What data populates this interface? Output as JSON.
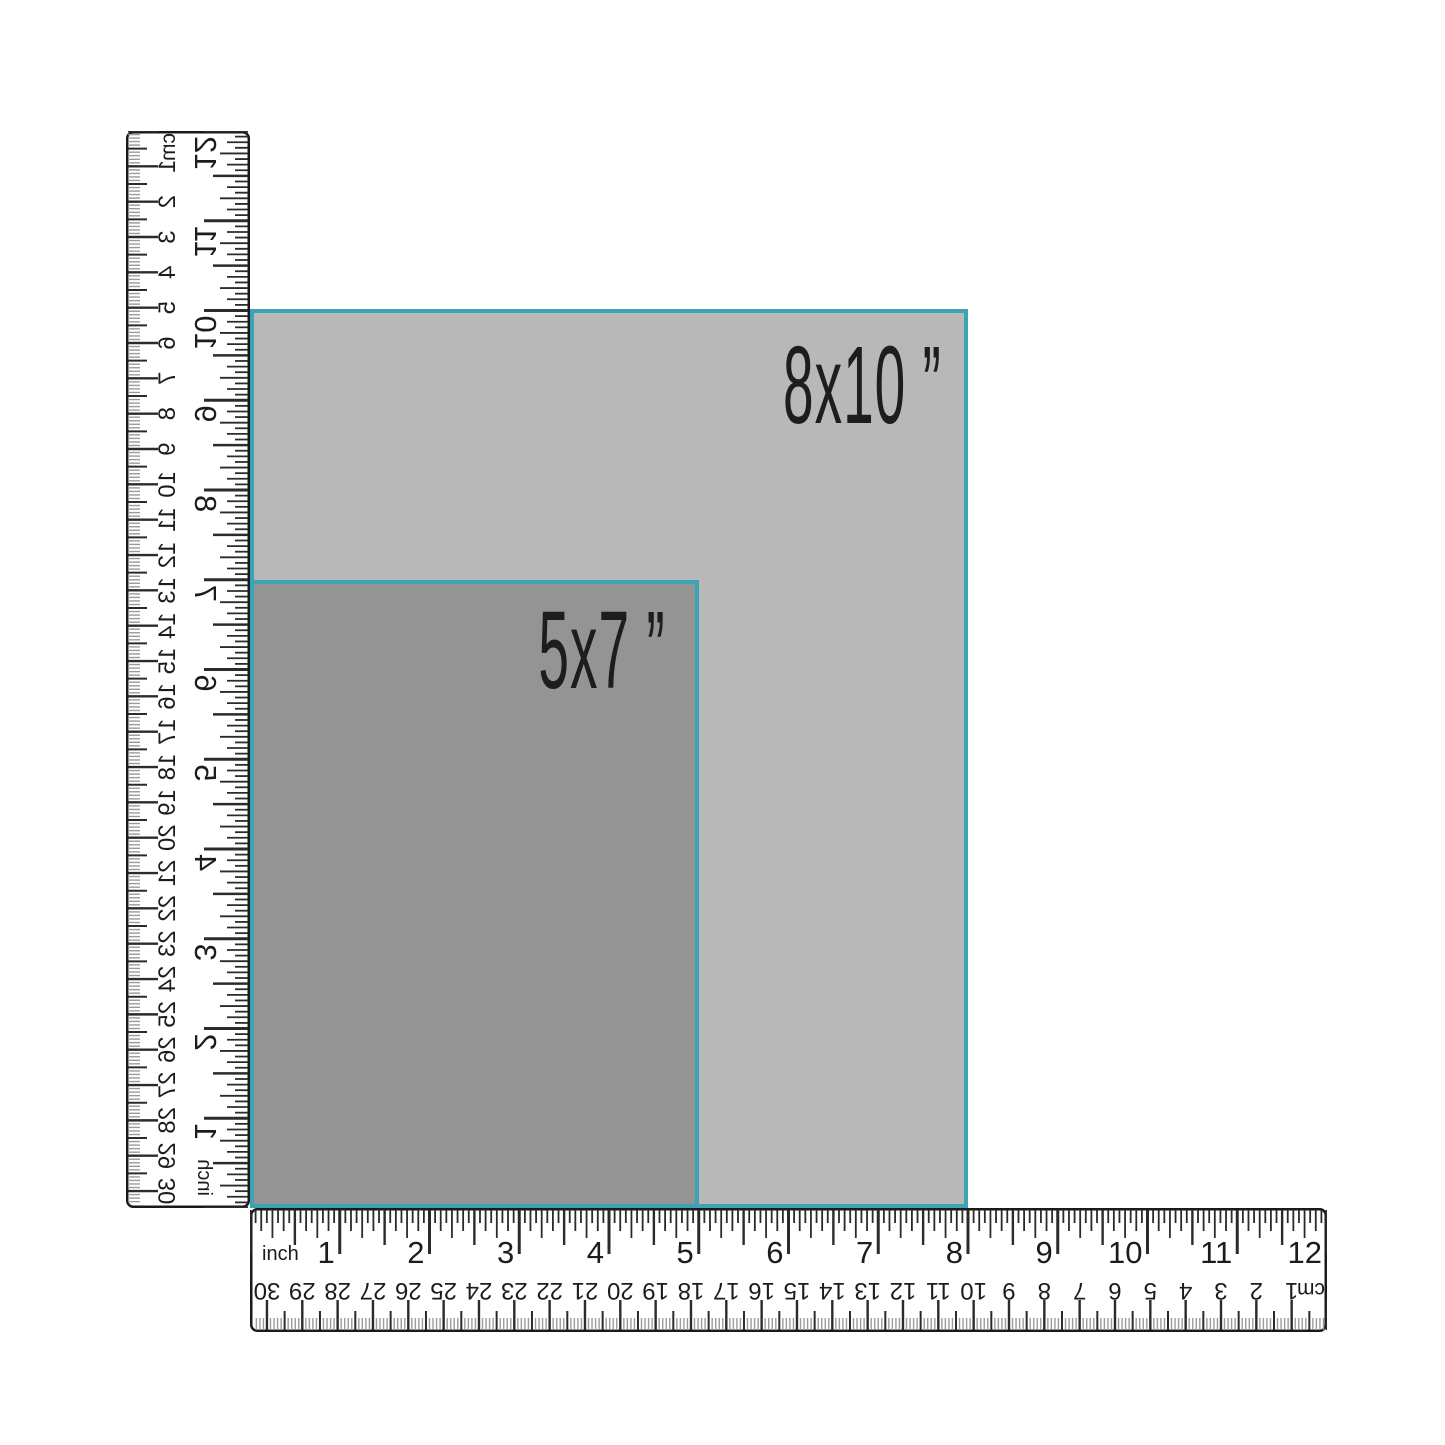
{
  "page": {
    "background_color": "#ffffff",
    "description": "Print size comparison diagram with rulers"
  },
  "size_guide": {
    "boxes": [
      {
        "name": "8x10",
        "label": "8x10 ”",
        "width_inches": 8,
        "height_inches": 10,
        "fill_color": "#b8b8b8",
        "border_color": "#3ba4b4",
        "text_color": "#1d1d1d"
      },
      {
        "name": "5x7",
        "label": "5x7 ”",
        "width_inches": 5,
        "height_inches": 7,
        "fill_color": "#949494",
        "border_color": "#3ba4b4",
        "text_color": "#1d1d1d"
      }
    ]
  },
  "rulers": {
    "inch_unit_label": "inch",
    "cm_unit_label": "cm",
    "inches_total": 12,
    "centimeters_total": 30,
    "inch_numbers": [
      "1",
      "2",
      "3",
      "4",
      "5",
      "6",
      "7",
      "8",
      "9",
      "10",
      "11",
      "12"
    ],
    "cm_numbers": [
      "1",
      "2",
      "3",
      "4",
      "5",
      "6",
      "7",
      "8",
      "9",
      "10",
      "11",
      "12",
      "13",
      "14",
      "15",
      "16",
      "17",
      "18",
      "19",
      "20",
      "21",
      "22",
      "23",
      "24",
      "25",
      "26",
      "27",
      "28",
      "29",
      "30"
    ],
    "length_px": 1077,
    "thickness_px": 124,
    "tick_color": "#2b2b2b",
    "mm_tick_color": "#9b9b9b",
    "text_color": "#1c1c1c",
    "border_color": "#1a1a1a",
    "background": "#ffffff"
  }
}
